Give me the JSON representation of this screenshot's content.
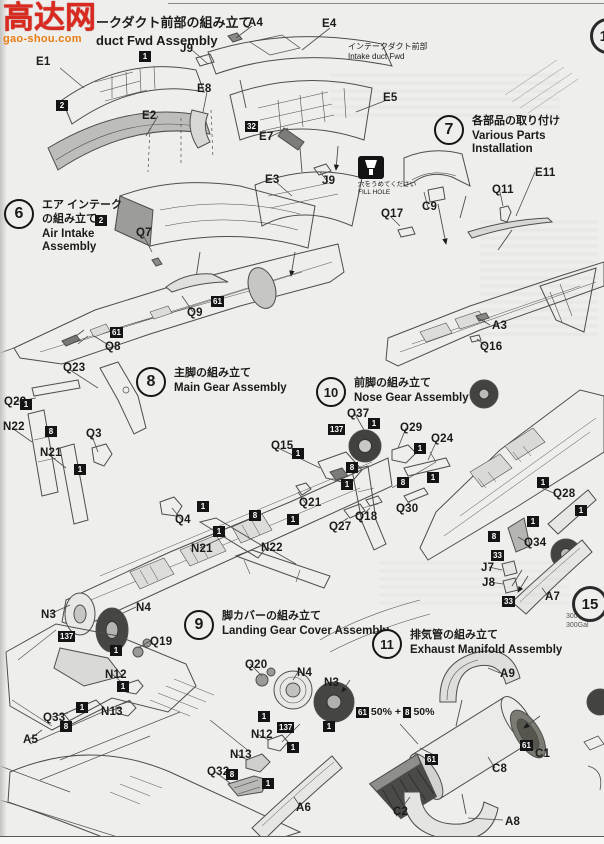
{
  "sheet": {
    "prev_section": {
      "jp": "ークダクト前部の組み立て",
      "en": "duct Fwd Assembly"
    },
    "watermark": {
      "main": "高达网",
      "sub": "gao-shou.com"
    },
    "intake_note": {
      "jp": "インテークダクト前部",
      "en": "Intake duct Fwd"
    },
    "fill_hole": {
      "jp": "穴をうめてください",
      "en": "FILL HOLE"
    },
    "side_note": {
      "line1": "300Gal",
      "line2": "300Gal"
    },
    "mix_note": {
      "paint1": "61",
      "text1": "50% +",
      "paint2": "8",
      "text2": "50%"
    }
  },
  "steps": [
    {
      "num": "6",
      "jp": "エア インテーク\nの組み立て",
      "en": "Air Intake\nAssembly",
      "x": 4,
      "y": 199
    },
    {
      "num": "7",
      "jp": "各部品の取り付け",
      "en": "Various Parts Installation",
      "x": 434,
      "y": 115
    },
    {
      "num": "8",
      "jp": "主脚の組み立て",
      "en": "Main Gear Assembly",
      "x": 136,
      "y": 367
    },
    {
      "num": "10",
      "jp": "前脚の組み立て",
      "en": "Nose Gear Assembly",
      "x": 316,
      "y": 377
    },
    {
      "num": "9",
      "jp": "脚カバーの組み立て",
      "en": "Landing Gear Cover Assembly",
      "x": 184,
      "y": 610
    },
    {
      "num": "11",
      "jp": "排気管の組み立て",
      "en": "Exhaust Manifold Assembly",
      "x": 372,
      "y": 629
    }
  ],
  "cut_step_circles": [
    {
      "num": "12",
      "x": 590,
      "y": 18
    },
    {
      "num": "15",
      "x": 572,
      "y": 586
    }
  ],
  "part_labels": [
    {
      "t": "A4",
      "x": 248,
      "y": 17
    },
    {
      "t": "E4",
      "x": 322,
      "y": 18
    },
    {
      "t": "J9",
      "x": 180,
      "y": 43
    },
    {
      "t": "E1",
      "x": 36,
      "y": 56
    },
    {
      "t": "E8",
      "x": 197,
      "y": 83
    },
    {
      "t": "E2",
      "x": 142,
      "y": 110
    },
    {
      "t": "E5",
      "x": 383,
      "y": 92
    },
    {
      "t": "E7",
      "x": 259,
      "y": 131
    },
    {
      "t": "E3",
      "x": 265,
      "y": 174
    },
    {
      "t": "J9",
      "x": 322,
      "y": 175
    },
    {
      "t": "Q17",
      "x": 381,
      "y": 208
    },
    {
      "t": "C9",
      "x": 422,
      "y": 201
    },
    {
      "t": "E11",
      "x": 535,
      "y": 167
    },
    {
      "t": "Q11",
      "x": 492,
      "y": 184
    },
    {
      "t": "A3",
      "x": 492,
      "y": 320
    },
    {
      "t": "Q16",
      "x": 480,
      "y": 341
    },
    {
      "t": "Q7",
      "x": 136,
      "y": 227
    },
    {
      "t": "Q9",
      "x": 187,
      "y": 307
    },
    {
      "t": "Q8",
      "x": 105,
      "y": 341
    },
    {
      "t": "Q23",
      "x": 63,
      "y": 362
    },
    {
      "t": "Q22",
      "x": 4,
      "y": 396
    },
    {
      "t": "N22",
      "x": 3,
      "y": 421
    },
    {
      "t": "Q3",
      "x": 86,
      "y": 428
    },
    {
      "t": "N21",
      "x": 40,
      "y": 447
    },
    {
      "t": "Q15",
      "x": 271,
      "y": 440
    },
    {
      "t": "Q4",
      "x": 175,
      "y": 514
    },
    {
      "t": "Q21",
      "x": 299,
      "y": 497
    },
    {
      "t": "N21",
      "x": 191,
      "y": 543
    },
    {
      "t": "N22",
      "x": 261,
      "y": 542
    },
    {
      "t": "Q37",
      "x": 347,
      "y": 408
    },
    {
      "t": "Q29",
      "x": 400,
      "y": 422
    },
    {
      "t": "Q24",
      "x": 431,
      "y": 433
    },
    {
      "t": "Q30",
      "x": 396,
      "y": 503
    },
    {
      "t": "Q28",
      "x": 553,
      "y": 488
    },
    {
      "t": "Q34",
      "x": 524,
      "y": 537
    },
    {
      "t": "J7",
      "x": 481,
      "y": 562
    },
    {
      "t": "J8",
      "x": 482,
      "y": 577
    },
    {
      "t": "A7",
      "x": 545,
      "y": 591
    },
    {
      "t": "Q18",
      "x": 355,
      "y": 511
    },
    {
      "t": "Q27",
      "x": 329,
      "y": 521
    },
    {
      "t": "N3",
      "x": 41,
      "y": 609
    },
    {
      "t": "N4",
      "x": 136,
      "y": 602
    },
    {
      "t": "Q19",
      "x": 150,
      "y": 636
    },
    {
      "t": "N12",
      "x": 105,
      "y": 669
    },
    {
      "t": "N13",
      "x": 101,
      "y": 706
    },
    {
      "t": "Q33",
      "x": 43,
      "y": 712
    },
    {
      "t": "A5",
      "x": 23,
      "y": 734
    },
    {
      "t": "Q20",
      "x": 245,
      "y": 659
    },
    {
      "t": "N4",
      "x": 297,
      "y": 667
    },
    {
      "t": "N3",
      "x": 324,
      "y": 677
    },
    {
      "t": "N12",
      "x": 251,
      "y": 729
    },
    {
      "t": "N13",
      "x": 230,
      "y": 749
    },
    {
      "t": "Q32",
      "x": 207,
      "y": 766
    },
    {
      "t": "A6",
      "x": 296,
      "y": 802
    },
    {
      "t": "A9",
      "x": 500,
      "y": 668
    },
    {
      "t": "C8",
      "x": 492,
      "y": 763
    },
    {
      "t": "C1",
      "x": 535,
      "y": 748
    },
    {
      "t": "C2",
      "x": 393,
      "y": 806
    },
    {
      "t": "A8",
      "x": 505,
      "y": 816
    }
  ],
  "paint_markers": [
    {
      "t": "1",
      "x": 139,
      "y": 51
    },
    {
      "t": "2",
      "x": 56,
      "y": 100
    },
    {
      "t": "2",
      "x": 95,
      "y": 215
    },
    {
      "t": "32",
      "x": 245,
      "y": 121
    },
    {
      "t": "61",
      "x": 211,
      "y": 296
    },
    {
      "t": "61",
      "x": 110,
      "y": 327
    },
    {
      "t": "1",
      "x": 20,
      "y": 399
    },
    {
      "t": "8",
      "x": 45,
      "y": 426
    },
    {
      "t": "1",
      "x": 74,
      "y": 464
    },
    {
      "t": "1",
      "x": 292,
      "y": 448
    },
    {
      "t": "1",
      "x": 197,
      "y": 501
    },
    {
      "t": "8",
      "x": 249,
      "y": 510
    },
    {
      "t": "1",
      "x": 287,
      "y": 514
    },
    {
      "t": "1",
      "x": 213,
      "y": 526
    },
    {
      "t": "137",
      "x": 328,
      "y": 424
    },
    {
      "t": "1",
      "x": 368,
      "y": 418
    },
    {
      "t": "1",
      "x": 414,
      "y": 443
    },
    {
      "t": "8",
      "x": 346,
      "y": 462
    },
    {
      "t": "1",
      "x": 341,
      "y": 479
    },
    {
      "t": "8",
      "x": 397,
      "y": 477
    },
    {
      "t": "1",
      "x": 427,
      "y": 472
    },
    {
      "t": "1",
      "x": 537,
      "y": 477
    },
    {
      "t": "1",
      "x": 575,
      "y": 505
    },
    {
      "t": "1",
      "x": 527,
      "y": 516
    },
    {
      "t": "8",
      "x": 488,
      "y": 531
    },
    {
      "t": "33",
      "x": 491,
      "y": 550
    },
    {
      "t": "33",
      "x": 502,
      "y": 596
    },
    {
      "t": "137",
      "x": 58,
      "y": 631
    },
    {
      "t": "1",
      "x": 110,
      "y": 645
    },
    {
      "t": "1",
      "x": 117,
      "y": 681
    },
    {
      "t": "1",
      "x": 76,
      "y": 702
    },
    {
      "t": "8",
      "x": 60,
      "y": 721
    },
    {
      "t": "1",
      "x": 258,
      "y": 711
    },
    {
      "t": "137",
      "x": 277,
      "y": 722
    },
    {
      "t": "1",
      "x": 323,
      "y": 721
    },
    {
      "t": "1",
      "x": 287,
      "y": 742
    },
    {
      "t": "8",
      "x": 226,
      "y": 769
    },
    {
      "t": "1",
      "x": 262,
      "y": 778
    },
    {
      "t": "61",
      "x": 425,
      "y": 754
    },
    {
      "t": "61",
      "x": 520,
      "y": 740
    }
  ]
}
